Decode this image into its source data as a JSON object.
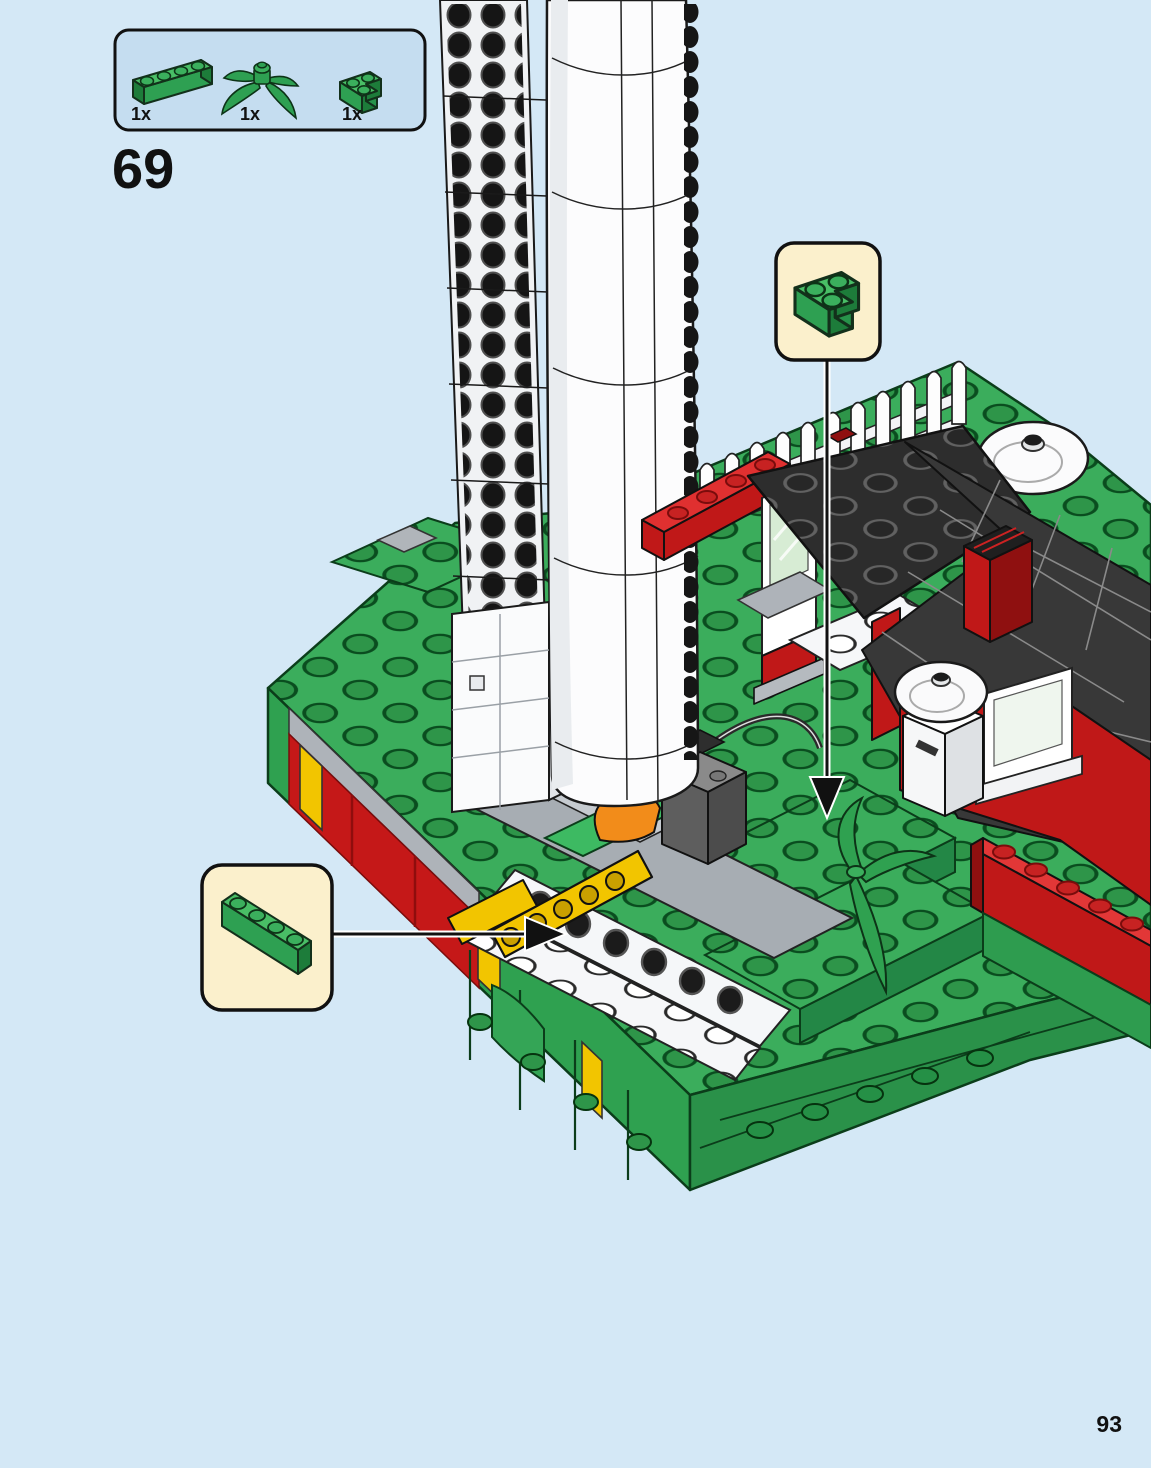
{
  "page": {
    "number": "93",
    "background_color": "#D4E8F6"
  },
  "step": {
    "number": "69"
  },
  "parts_box": {
    "items": [
      {
        "part": "green-brick-1x4",
        "count_label": "1x"
      },
      {
        "part": "green-plant-stem",
        "count_label": "1x"
      },
      {
        "part": "green-corner-brick-2x2",
        "count_label": "1x"
      }
    ]
  },
  "callouts": [
    {
      "part": "green-corner-brick-2x2",
      "direction": "down"
    },
    {
      "part": "green-brick-1x4",
      "direction": "right"
    }
  ],
  "colors": {
    "background": "#D4E8F6",
    "parts_panel": "#C5DDF0",
    "callout_panel": "#FBF0CC",
    "brick_green": "#2EA052",
    "brick_red": "#C01818",
    "accent_yellow": "#F2C500",
    "roof_black": "#2D2D2D",
    "outline": "#111111"
  }
}
